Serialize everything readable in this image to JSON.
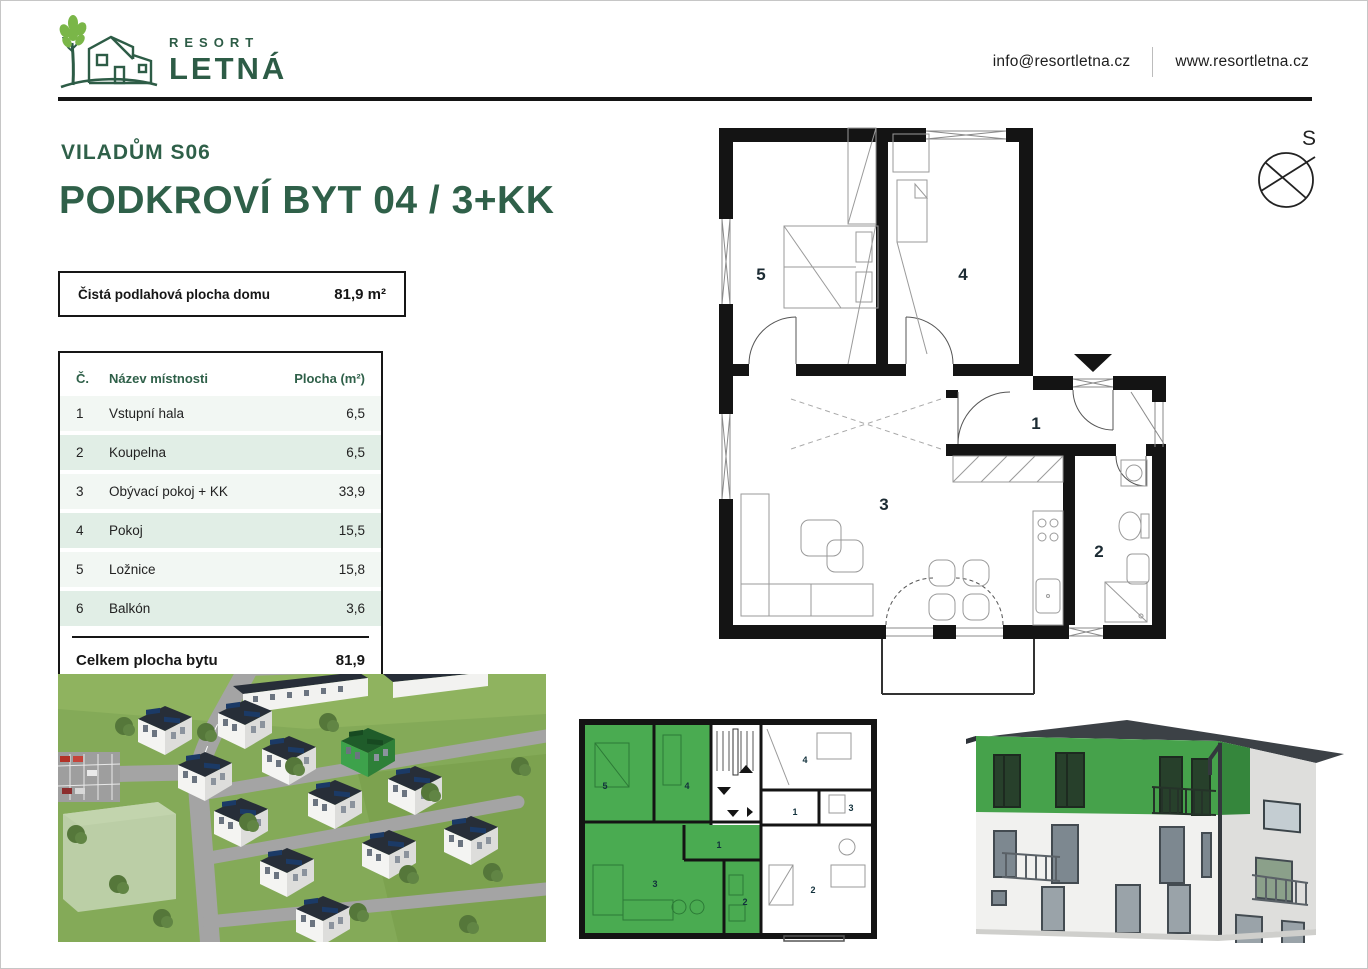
{
  "header": {
    "brand_top": "RESORT",
    "brand_bottom": "LETNÁ",
    "email": "info@resortletna.cz",
    "website": "www.resortletna.cz"
  },
  "title": {
    "subtitle": "VILADŮM S06",
    "main": "PODKROVÍ BYT 04 / 3+KK"
  },
  "area_box": {
    "label": "Čistá podlahová plocha domu",
    "value": "81,9 m²"
  },
  "room_table": {
    "columns": {
      "num": "Č.",
      "name": "Název místnosti",
      "area": "Plocha (m²)"
    },
    "rows": [
      {
        "num": "1",
        "name": "Vstupní hala",
        "area": "6,5"
      },
      {
        "num": "2",
        "name": "Koupelna",
        "area": "6,5"
      },
      {
        "num": "3",
        "name": "Obývací pokoj + KK",
        "area": "33,9"
      },
      {
        "num": "4",
        "name": "Pokoj",
        "area": "15,5"
      },
      {
        "num": "5",
        "name": "Ložnice",
        "area": "15,8"
      },
      {
        "num": "6",
        "name": "Balkón",
        "area": "3,6"
      }
    ],
    "total_label": "Celkem plocha bytu",
    "total_value": "81,9"
  },
  "compass": {
    "label": "S"
  },
  "plan": {
    "labels": {
      "hall": "1",
      "bath": "2",
      "living": "3",
      "room": "4",
      "bedroom": "5"
    }
  },
  "mini_plan": {
    "left_unit": [
      "5",
      "4",
      "1",
      "3",
      "2"
    ],
    "right_unit": [
      "4",
      "1",
      "3",
      "2"
    ]
  },
  "colors": {
    "brand_green": "#2f6049",
    "highlight_green": "#4aab51",
    "table_row_green": "#e1eee6",
    "wall_black": "#141414"
  }
}
